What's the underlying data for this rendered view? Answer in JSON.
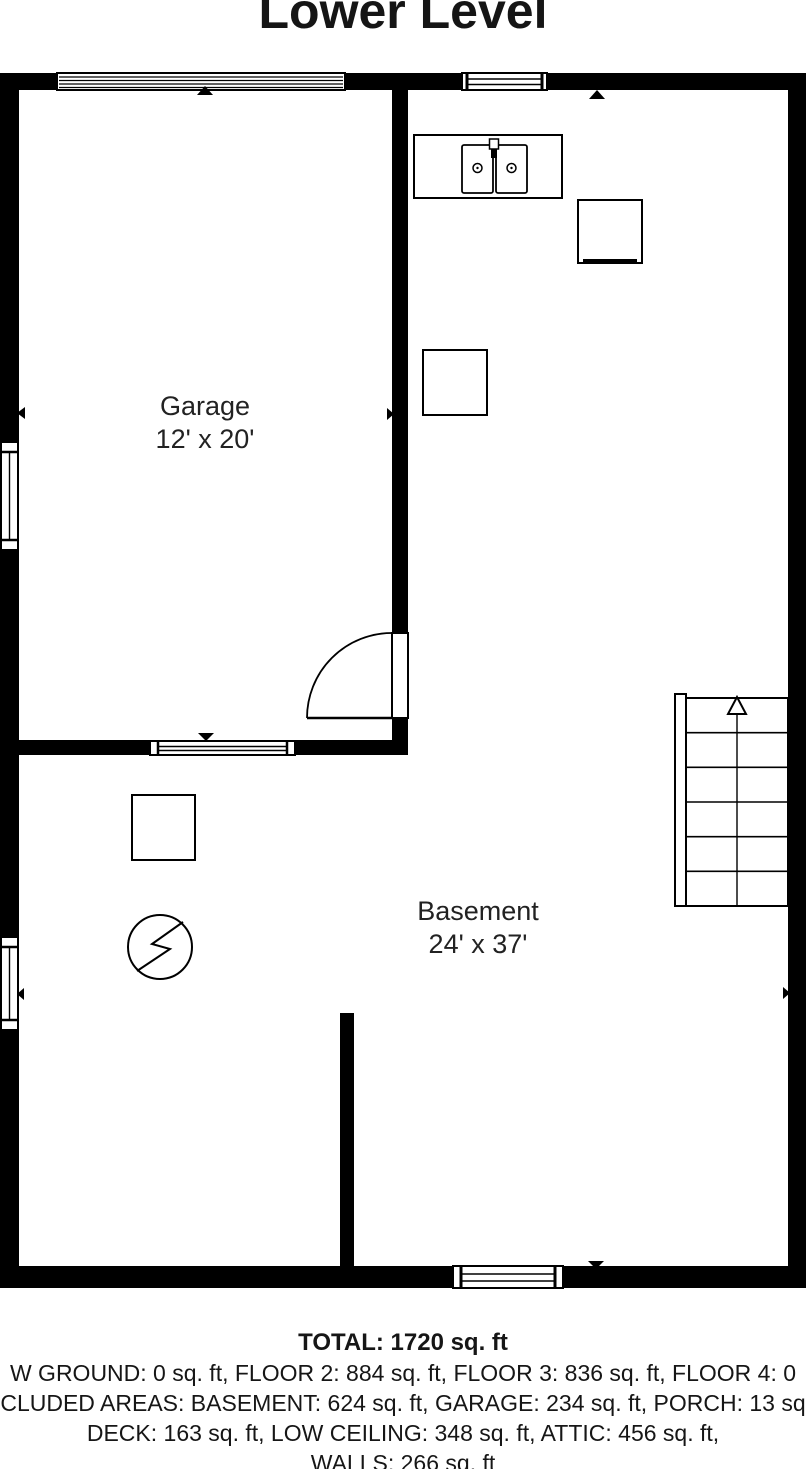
{
  "title": "Lower Level",
  "rooms": {
    "garage": {
      "name": "Garage",
      "dimensions": "12' x 20'"
    },
    "basement": {
      "name": "Basement",
      "dimensions": "24' x 37'"
    }
  },
  "summary": {
    "total": "TOTAL: 1720 sq. ft",
    "line_floors": "W GROUND: 0 sq. ft, FLOOR 2: 884 sq. ft, FLOOR 3: 836 sq. ft, FLOOR 4: 0",
    "line_excluded": "CLUDED AREAS: BASEMENT: 624 sq. ft, GARAGE: 234 sq. ft, PORCH: 13 sq",
    "line_deck": "DECK: 163 sq. ft, LOW CEILING: 348 sq. ft, ATTIC: 456 sq. ft,",
    "line_walls": "WALLS: 266 sq. ft"
  },
  "colors": {
    "wall": "#000000",
    "background": "#ffffff",
    "text": "#1a1a1a"
  }
}
